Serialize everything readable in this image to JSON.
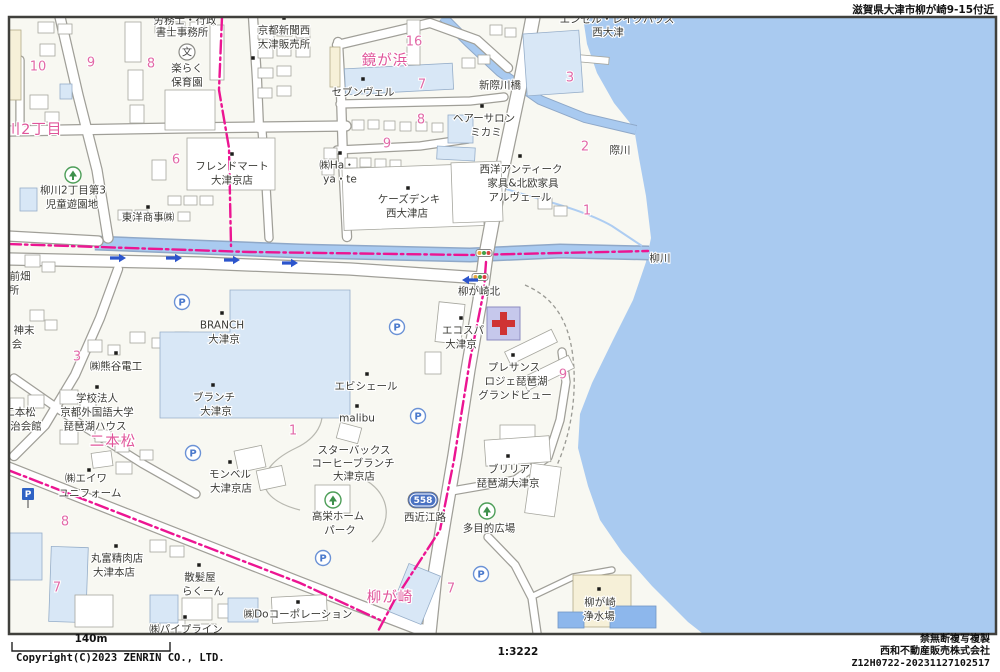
{
  "header": {
    "area_label": "滋賀県大津市柳が崎9-15付近"
  },
  "footer": {
    "scale_bar_label": "140m",
    "scale_ratio": "1:3222",
    "copyright": "Copyright(C)2023 ZENRIN CO., LTD.",
    "notice": "禁無断複写複製",
    "company": "西和不動産販売株式会社",
    "code": "Z12H0722-20231127102517"
  },
  "map": {
    "colors": {
      "water": "#a9caf0",
      "boundary": "#ec1592",
      "place_pink": "#e0559a",
      "number_pink": "#e26aa8",
      "label_dark": "#3b3b36"
    },
    "route_shield": {
      "number": "558",
      "x": 423,
      "y": 500
    },
    "labels": [
      {
        "t": "労務士・行政",
        "x": 185,
        "y": 20,
        "c": "dk"
      },
      {
        "t": "書士事務所",
        "x": 182,
        "y": 32,
        "c": "dk"
      },
      {
        "t": "楽らく",
        "x": 187,
        "y": 68,
        "c": "dk"
      },
      {
        "t": "保育園",
        "x": 187,
        "y": 82,
        "c": "dk"
      },
      {
        "t": "京都新聞西",
        "x": 284,
        "y": 30,
        "c": "dk"
      },
      {
        "t": "大津販売所",
        "x": 284,
        "y": 44,
        "c": "dk"
      },
      {
        "t": "セブンヴェル",
        "x": 363,
        "y": 92,
        "c": "dk"
      },
      {
        "t": "新際川橋",
        "x": 500,
        "y": 85,
        "c": "dk"
      },
      {
        "t": "エンゼル・レイクハウス",
        "x": 617,
        "y": 19,
        "c": "dk"
      },
      {
        "t": "西大津",
        "x": 608,
        "y": 32,
        "c": "dk"
      },
      {
        "t": "ヘアーサロン",
        "x": 484,
        "y": 118,
        "c": "dk"
      },
      {
        "t": "ミカミ",
        "x": 486,
        "y": 132,
        "c": "dk"
      },
      {
        "t": "西洋アンティーク",
        "x": 521,
        "y": 169,
        "c": "dk"
      },
      {
        "t": "家具&北欧家具",
        "x": 523,
        "y": 183,
        "c": "dk"
      },
      {
        "t": "アルヴェール",
        "x": 520,
        "y": 197,
        "c": "dk"
      },
      {
        "t": "㈱Ha・",
        "x": 337,
        "y": 165,
        "c": "dk"
      },
      {
        "t": "ya・te",
        "x": 340,
        "y": 179,
        "c": "dk"
      },
      {
        "t": "ケーズデンキ",
        "x": 409,
        "y": 199,
        "c": "dk"
      },
      {
        "t": "西大津店",
        "x": 407,
        "y": 213,
        "c": "dk"
      },
      {
        "t": "フレンドマート",
        "x": 232,
        "y": 166,
        "c": "dk"
      },
      {
        "t": "大津京店",
        "x": 232,
        "y": 180,
        "c": "dk"
      },
      {
        "t": "東洋商事㈱",
        "x": 148,
        "y": 217,
        "c": "dk"
      },
      {
        "t": "柳川2丁目第3",
        "x": 73,
        "y": 190,
        "c": "dk"
      },
      {
        "t": "児童遊園地",
        "x": 72,
        "y": 204,
        "c": "dk"
      },
      {
        "t": "前畑",
        "x": 20,
        "y": 276,
        "c": "dk"
      },
      {
        "t": "所",
        "x": 14,
        "y": 290,
        "c": "dk"
      },
      {
        "t": "神末",
        "x": 24,
        "y": 330,
        "c": "dk"
      },
      {
        "t": "会",
        "x": 17,
        "y": 344,
        "c": "dk"
      },
      {
        "t": "㈱熊谷電工",
        "x": 116,
        "y": 366,
        "c": "dk"
      },
      {
        "t": "学校法人",
        "x": 97,
        "y": 398,
        "c": "dk"
      },
      {
        "t": "京都外国語大学",
        "x": 97,
        "y": 412,
        "c": "dk"
      },
      {
        "t": "琵琶湖ハウス",
        "x": 95,
        "y": 426,
        "c": "dk"
      },
      {
        "t": "二本松",
        "x": 20,
        "y": 412,
        "c": "dk"
      },
      {
        "t": "治会館",
        "x": 26,
        "y": 426,
        "c": "dk"
      },
      {
        "t": "㈱エイワ",
        "x": 86,
        "y": 478,
        "c": "dk"
      },
      {
        "t": "ユニフォーム",
        "x": 90,
        "y": 493,
        "c": "dk"
      },
      {
        "t": "丸富精肉店",
        "x": 117,
        "y": 558,
        "c": "dk"
      },
      {
        "t": "大津本店",
        "x": 114,
        "y": 572,
        "c": "dk"
      },
      {
        "t": "散髪屋",
        "x": 200,
        "y": 577,
        "c": "dk"
      },
      {
        "t": "らくーん",
        "x": 203,
        "y": 591,
        "c": "dk"
      },
      {
        "t": "㈱Doコーポレーション",
        "x": 298,
        "y": 614,
        "c": "dk"
      },
      {
        "t": "㈱パイプライン",
        "x": 186,
        "y": 629,
        "c": "dk"
      },
      {
        "t": "BRANCH",
        "x": 222,
        "y": 325,
        "c": "dk"
      },
      {
        "t": "大津京",
        "x": 224,
        "y": 339,
        "c": "dk"
      },
      {
        "t": "ブランチ",
        "x": 214,
        "y": 397,
        "c": "dk"
      },
      {
        "t": "大津京",
        "x": 216,
        "y": 411,
        "c": "dk"
      },
      {
        "t": "エビシェール",
        "x": 366,
        "y": 386,
        "c": "dk"
      },
      {
        "t": "malibu",
        "x": 357,
        "y": 418,
        "c": "dk"
      },
      {
        "t": "スターバックス",
        "x": 354,
        "y": 450,
        "c": "dk"
      },
      {
        "t": "コーヒーブランチ",
        "x": 353,
        "y": 463,
        "c": "dk"
      },
      {
        "t": "大津京店",
        "x": 354,
        "y": 476,
        "c": "dk"
      },
      {
        "t": "モンベル",
        "x": 230,
        "y": 474,
        "c": "dk"
      },
      {
        "t": "大津京店",
        "x": 231,
        "y": 488,
        "c": "dk"
      },
      {
        "t": "高栄ホーム",
        "x": 338,
        "y": 516,
        "c": "dk"
      },
      {
        "t": "パーク",
        "x": 340,
        "y": 530,
        "c": "dk"
      },
      {
        "t": "エコスパ",
        "x": 463,
        "y": 330,
        "c": "dk"
      },
      {
        "t": "大津京",
        "x": 461,
        "y": 344,
        "c": "dk"
      },
      {
        "t": "柳が崎北",
        "x": 479,
        "y": 291,
        "c": "dk"
      },
      {
        "t": "プレサンス",
        "x": 514,
        "y": 367,
        "c": "dk"
      },
      {
        "t": "ロジェ琵琶湖",
        "x": 516,
        "y": 381,
        "c": "dk"
      },
      {
        "t": "グランドビュー",
        "x": 515,
        "y": 395,
        "c": "dk"
      },
      {
        "t": "ブリリア",
        "x": 509,
        "y": 469,
        "c": "dk"
      },
      {
        "t": "琵琶湖大津京",
        "x": 508,
        "y": 483,
        "c": "dk"
      },
      {
        "t": "多目的広場",
        "x": 489,
        "y": 528,
        "c": "dk"
      },
      {
        "t": "西近江路",
        "x": 425,
        "y": 517,
        "c": "dk"
      },
      {
        "t": "柳が崎",
        "x": 600,
        "y": 602,
        "c": "dk"
      },
      {
        "t": "浄水場",
        "x": 599,
        "y": 616,
        "c": "dk"
      },
      {
        "t": "際川",
        "x": 620,
        "y": 150,
        "c": "dk"
      },
      {
        "t": "柳川",
        "x": 660,
        "y": 258,
        "c": "dk"
      },
      {
        "t": "鏡が浜",
        "x": 385,
        "y": 60,
        "c": "pk"
      },
      {
        "t": "川2丁目",
        "x": 34,
        "y": 129,
        "c": "pk"
      },
      {
        "t": "二本松",
        "x": 113,
        "y": 441,
        "c": "pk"
      },
      {
        "t": "柳が崎",
        "x": 390,
        "y": 597,
        "c": "pk",
        "s": 16
      },
      {
        "t": "10",
        "x": 38,
        "y": 66,
        "c": "num"
      },
      {
        "t": "9",
        "x": 91,
        "y": 62,
        "c": "num"
      },
      {
        "t": "8",
        "x": 151,
        "y": 63,
        "c": "num"
      },
      {
        "t": "16",
        "x": 414,
        "y": 41,
        "c": "num"
      },
      {
        "t": "7",
        "x": 422,
        "y": 84,
        "c": "num"
      },
      {
        "t": "8",
        "x": 421,
        "y": 119,
        "c": "num"
      },
      {
        "t": "9",
        "x": 387,
        "y": 143,
        "c": "num"
      },
      {
        "t": "6",
        "x": 176,
        "y": 159,
        "c": "num"
      },
      {
        "t": "3",
        "x": 570,
        "y": 77,
        "c": "num"
      },
      {
        "t": "2",
        "x": 585,
        "y": 146,
        "c": "num"
      },
      {
        "t": "1",
        "x": 587,
        "y": 210,
        "c": "num"
      },
      {
        "t": "3",
        "x": 77,
        "y": 356,
        "c": "num"
      },
      {
        "t": "1",
        "x": 293,
        "y": 430,
        "c": "num"
      },
      {
        "t": "9",
        "x": 563,
        "y": 374,
        "c": "num"
      },
      {
        "t": "8",
        "x": 65,
        "y": 521,
        "c": "num"
      },
      {
        "t": "7",
        "x": 57,
        "y": 587,
        "c": "num"
      },
      {
        "t": "7",
        "x": 451,
        "y": 588,
        "c": "num"
      }
    ],
    "poi_dots": [
      [
        284,
        18
      ],
      [
        363,
        79
      ],
      [
        482,
        106
      ],
      [
        520,
        156
      ],
      [
        340,
        153
      ],
      [
        408,
        188
      ],
      [
        232,
        154
      ],
      [
        148,
        207
      ],
      [
        116,
        353
      ],
      [
        97,
        387
      ],
      [
        222,
        313
      ],
      [
        213,
        385
      ],
      [
        367,
        374
      ],
      [
        357,
        406
      ],
      [
        230,
        462
      ],
      [
        116,
        546
      ],
      [
        199,
        565
      ],
      [
        298,
        602
      ],
      [
        185,
        617
      ],
      [
        461,
        318
      ],
      [
        513,
        355
      ],
      [
        508,
        456
      ],
      [
        599,
        589
      ],
      [
        89,
        470
      ],
      [
        253,
        58
      ]
    ],
    "icons": {
      "parking_glyph": "P",
      "school_glyph": "文",
      "parking_circles": [
        [
          182,
          302
        ],
        [
          397,
          327
        ],
        [
          193,
          453
        ],
        [
          418,
          416
        ],
        [
          323,
          558
        ],
        [
          481,
          574
        ]
      ],
      "parking_sign": [
        [
          28,
          494
        ]
      ],
      "trees": [
        [
          73,
          175
        ],
        [
          333,
          500
        ],
        [
          487,
          511
        ]
      ],
      "school": [
        [
          187,
          52
        ]
      ],
      "signals": [
        [
          484,
          253
        ],
        [
          480,
          277
        ]
      ],
      "arrows_right": [
        [
          118,
          258
        ],
        [
          174,
          258
        ],
        [
          232,
          260
        ],
        [
          290,
          263
        ]
      ],
      "arrows_left": [
        [
          470,
          280
        ]
      ],
      "hospital": [
        [
          487,
          307
        ]
      ]
    }
  }
}
